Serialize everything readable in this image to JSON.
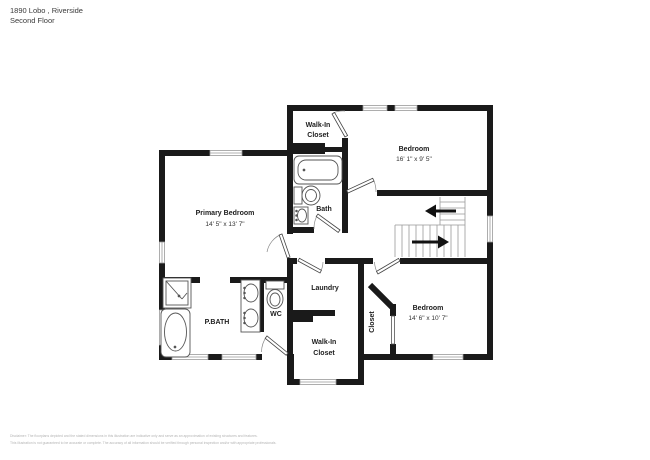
{
  "header": {
    "address": "1890 Lobo , Riverside",
    "floor": "Second Floor"
  },
  "floorplan": {
    "rooms": {
      "walk_in_closet_top": {
        "line1": "Walk-In",
        "line2": "Closet"
      },
      "bedroom_top": {
        "name": "Bedroom",
        "dims": "16' 1\" x 9' 5\""
      },
      "primary_bedroom": {
        "name": "Primary Bedroom",
        "dims": "14' 5\" x 13' 7\""
      },
      "bath": {
        "name": "Bath"
      },
      "laundry": {
        "name": "Laundry"
      },
      "wc": {
        "name": "WC"
      },
      "pbath": {
        "name": "P.BATH"
      },
      "walk_in_closet_bottom": {
        "line1": "Walk-In",
        "line2": "Closet"
      },
      "closet": {
        "name": "Closet"
      },
      "bedroom_bottom": {
        "name": "Bedroom",
        "dims": "14' 6\" x 10' 7\""
      }
    },
    "colors": {
      "wall": "#1a1a1a",
      "fixture_outline": "#555555",
      "window_line": "#999999",
      "arc": "#888888"
    }
  },
  "footer": {
    "line1": "Disclaimer: The floorplans depicted and the stated dimensions in this illustration are indicative only and serve as an approximation of existing structures and features.",
    "line2": "This illustration is not guaranteed to be accurate or complete. The accuracy of all information should be verified through personal inspection and/or with appropriate professionals."
  }
}
